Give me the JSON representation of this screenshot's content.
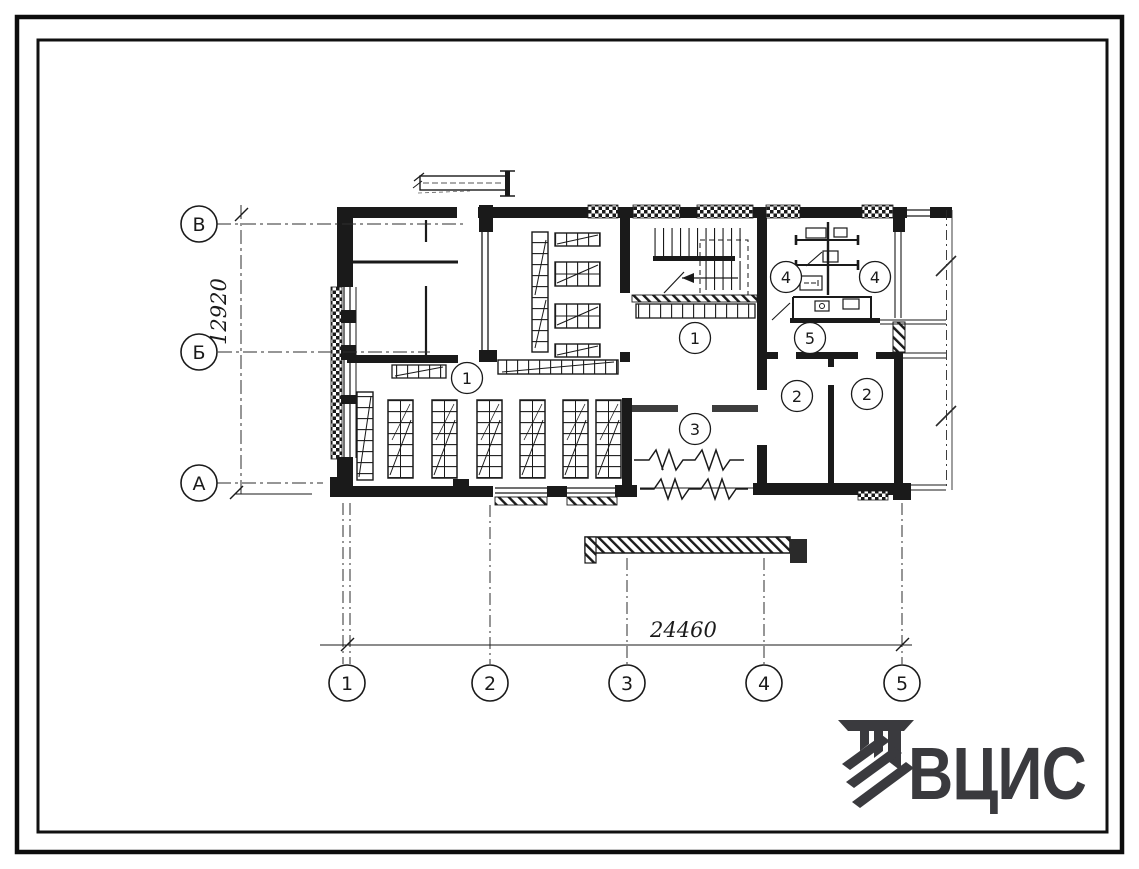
{
  "sheet": {
    "type": "architectural floor plan (scanned blueprint)",
    "background": "#ffffff",
    "ink": "#1a1a1a"
  },
  "axes": {
    "vertical": [
      {
        "label": "В"
      },
      {
        "label": "Б"
      },
      {
        "label": "А"
      }
    ],
    "horizontal": [
      {
        "label": "1"
      },
      {
        "label": "2"
      },
      {
        "label": "3"
      },
      {
        "label": "4"
      },
      {
        "label": "5"
      }
    ]
  },
  "dimensions": {
    "vertical_total": "12920",
    "horizontal_total": "24460"
  },
  "rooms": [
    {
      "label": "1"
    },
    {
      "label": "1"
    },
    {
      "label": "3"
    },
    {
      "label": "4"
    },
    {
      "label": "4"
    },
    {
      "label": "5"
    },
    {
      "label": "2"
    },
    {
      "label": "2"
    }
  ],
  "logo": {
    "text": "ВЦИС",
    "color": "#3a3a3e"
  }
}
